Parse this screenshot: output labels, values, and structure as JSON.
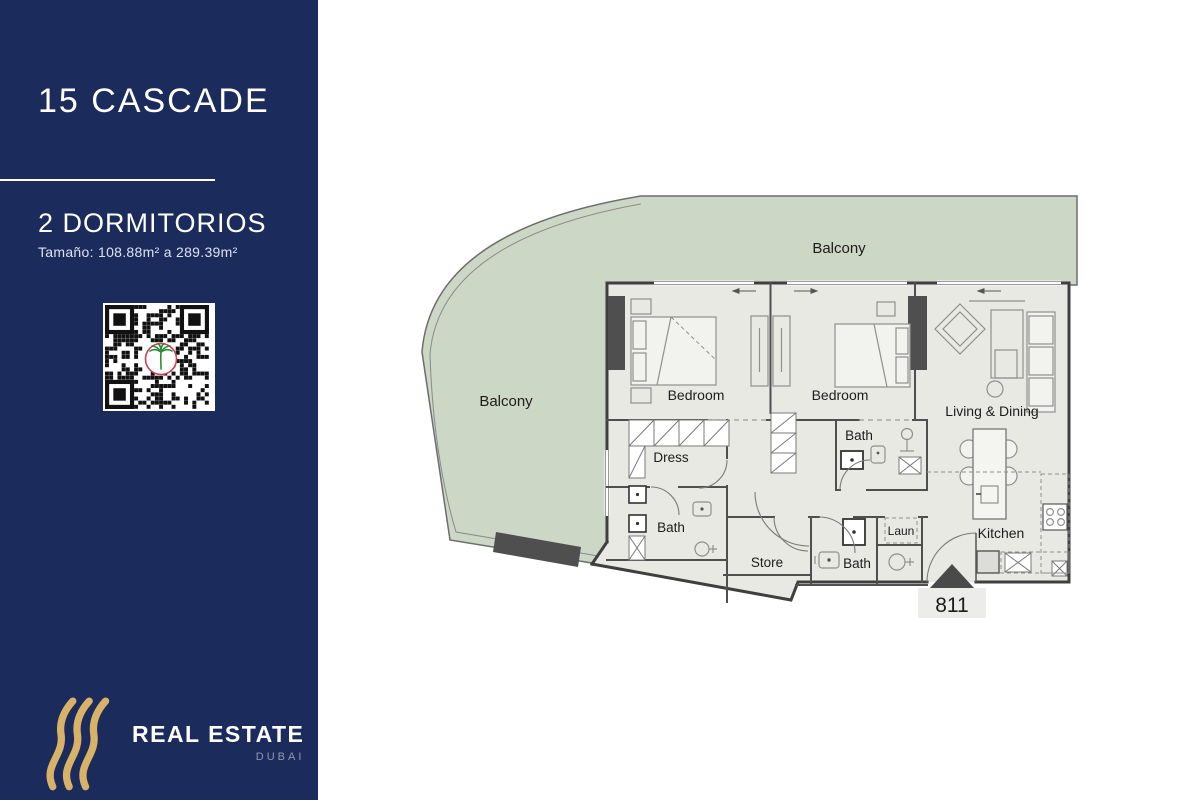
{
  "sidebar": {
    "title": "15 CASCADE",
    "subtitle": "2 DORMITORIOS",
    "size_text": "Tamaño: 108.88m² a 289.39m²",
    "brand": {
      "name": "REAL ESTATE",
      "location": "DUBAI"
    },
    "colors": {
      "background": "#1B2B5C",
      "accent_gold": "#D8B267"
    }
  },
  "floorplan": {
    "unit_number": "811",
    "labels": {
      "balcony_top": "Balcony",
      "balcony_left": "Balcony",
      "bedroom1": "Bedroom",
      "bedroom2": "Bedroom",
      "living": "Living & Dining",
      "dress": "Dress",
      "bath1": "Bath",
      "bath2": "Bath",
      "bath3": "Bath",
      "store": "Store",
      "laundry": "Laun",
      "kitchen": "Kitchen"
    },
    "colors": {
      "balcony": "#CDD7C6",
      "interior": "#E9E9E4",
      "wall": "#3F3F3F"
    }
  }
}
